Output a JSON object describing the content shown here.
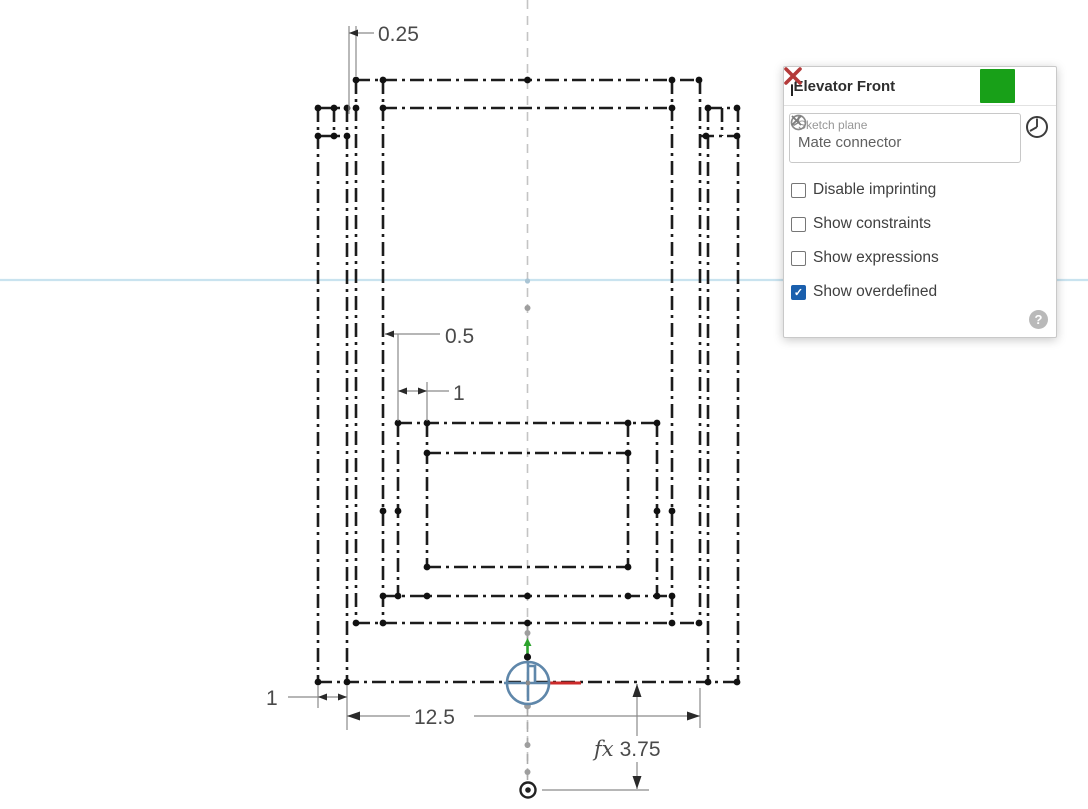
{
  "canvas": {
    "dimensions": {
      "top_offset": "0.25",
      "inner_offset": "0.5",
      "inner_gap": "1",
      "rail_width": "1",
      "overall_width": "12.5",
      "origin_distance_prefix": "fx",
      "origin_distance": "3.75"
    },
    "colors": {
      "sketch_line": "#1c1c1c",
      "dimension_line": "#8a8a8a",
      "dimension_text": "#4a4a4a",
      "centerline": "#c4c4c4",
      "section_line": "#c9e3ef",
      "axis_x_red": "#cc2a2a",
      "axis_y_green": "#2da32d",
      "mate_connector_blue": "#5f87aa"
    }
  },
  "dialog": {
    "title": "Elevator Front",
    "sketch_plane": {
      "label": "Sketch plane",
      "value": "Mate connector"
    },
    "options": [
      {
        "label": "Disable imprinting",
        "checked": false
      },
      {
        "label": "Show constraints",
        "checked": false
      },
      {
        "label": "Show expressions",
        "checked": false
      },
      {
        "label": "Show overdefined",
        "checked": true
      }
    ],
    "help_label": "?",
    "colors": {
      "confirm_green": "#18a018",
      "cancel_red": "#b43a3a",
      "checkbox_checked": "#1a5fad"
    }
  }
}
